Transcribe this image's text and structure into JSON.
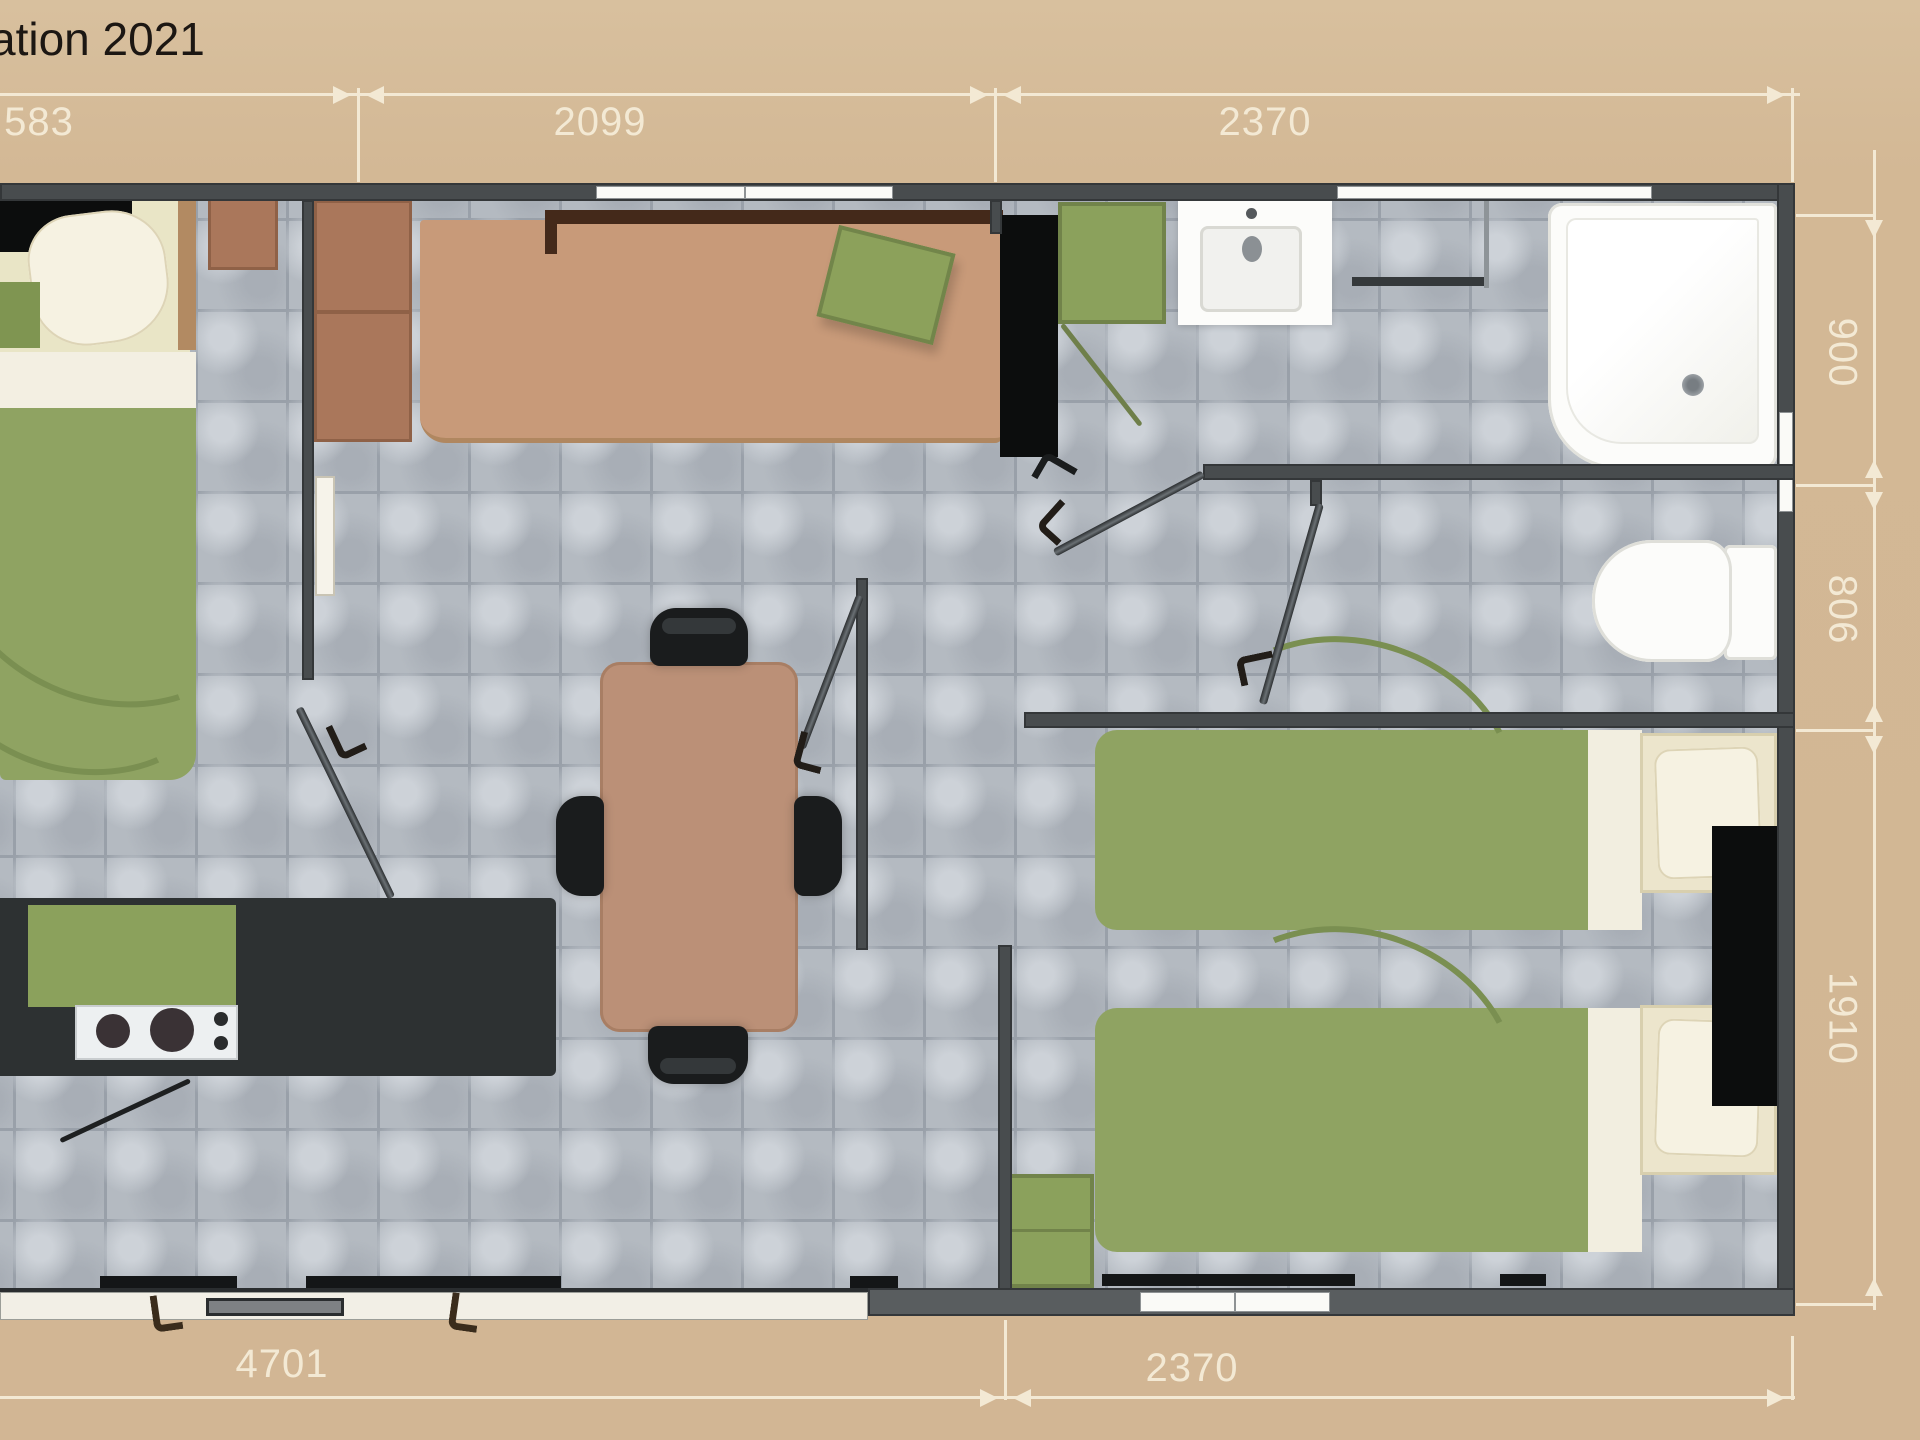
{
  "title": {
    "text": "ation 2021"
  },
  "dimensions": {
    "top_left": "583",
    "top_middle": "2099",
    "top_right": "2370",
    "right_top": "900",
    "right_middle": "806",
    "right_bottom": "1910",
    "bottom_left": "4701",
    "bottom_right": "2370"
  },
  "palette": {
    "bg": "#d3b895",
    "dim": "#f3e9d4",
    "ink": "#1c1713",
    "wall": "#484c4e",
    "wall-dark": "#2e3133",
    "tile": "#b4bac1",
    "grout": "#99a0a9",
    "duvet": "#8fa362",
    "duvet-dark": "#7a8f51",
    "cream": "#ece5cc",
    "pillow": "#f6f2e2",
    "sofa": "#c89a79",
    "sofa-edge": "#b08760",
    "backrest": "#44291a",
    "wood": "#aa775b",
    "counter": "#2d3132",
    "black": "#0c0d0d",
    "cabgreen": "#8ba15c",
    "fixture": "#fcfcfa",
    "metal": "#55595c"
  }
}
